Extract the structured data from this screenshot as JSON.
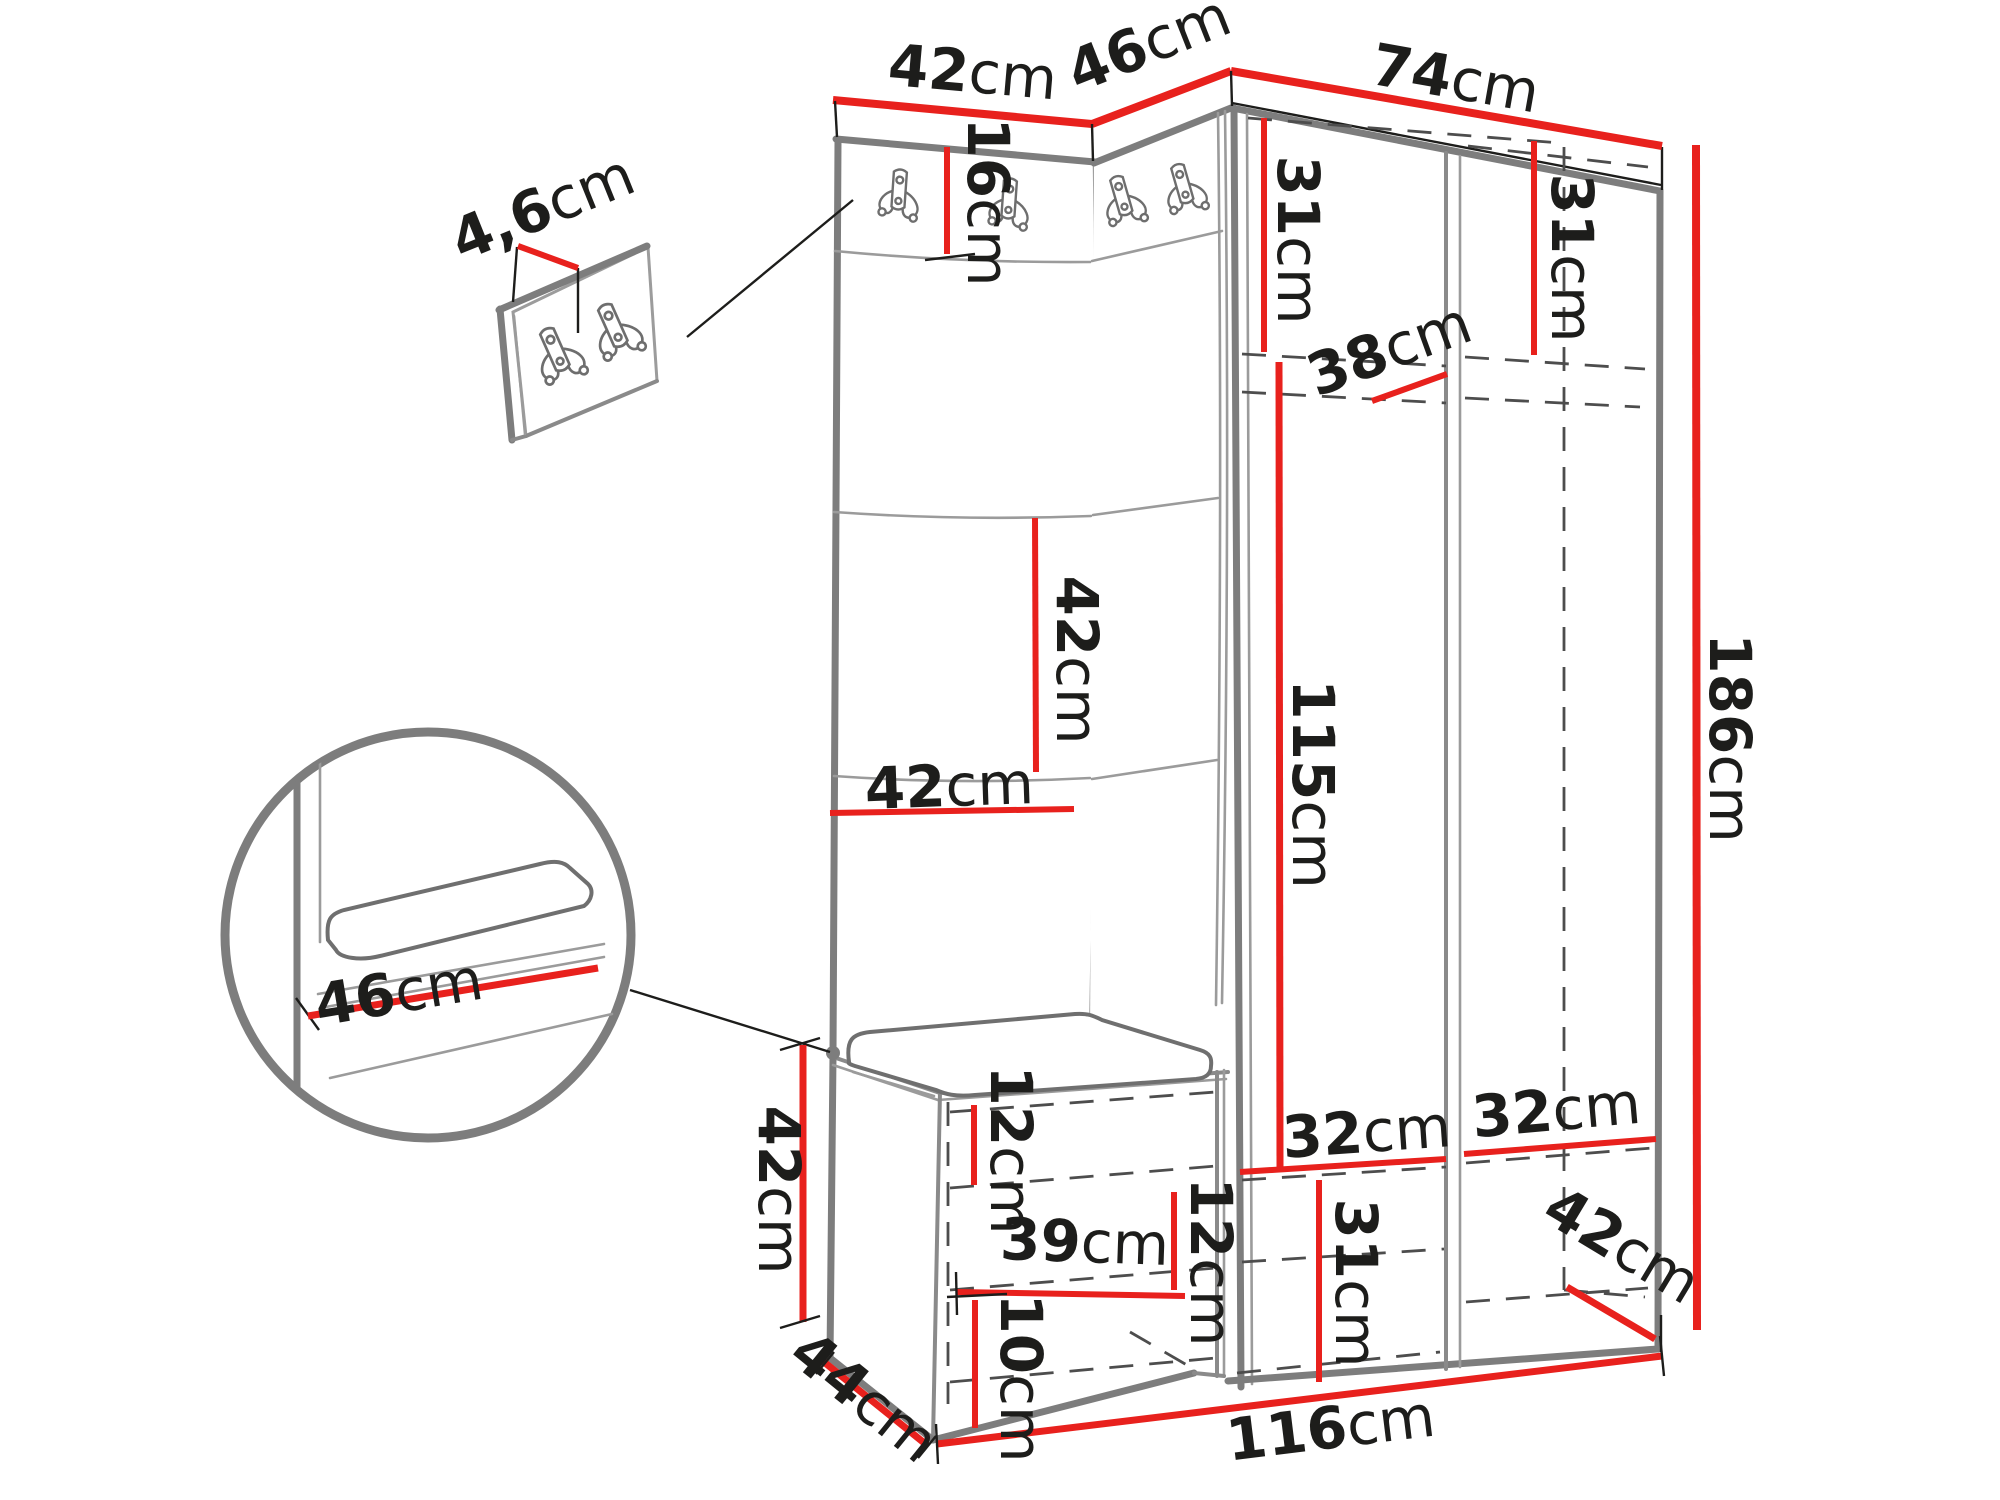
{
  "diagram": {
    "type": "furniture-dimension-diagram",
    "background": "#ffffff",
    "colors": {
      "dimension_line": "#e8211d",
      "outline_gray": "#7d7d7d",
      "hidden_line_dash": "#4d4d4d",
      "text": "#1d1d1b"
    },
    "icons": {
      "coat_hook": "double-coat-hook-icon",
      "detail_circle": "magnified-detail-circle",
      "detail_panel": "hook-panel-detail"
    },
    "dims": {
      "top_left_width": {
        "num": "42",
        "unit": "cm"
      },
      "corner_width": {
        "num": "46",
        "unit": "cm"
      },
      "right_width": {
        "num": "74",
        "unit": "cm"
      },
      "panel_thickness": {
        "num": "4,6",
        "unit": "cm"
      },
      "hook_strip_height": {
        "num": "16",
        "unit": "cm"
      },
      "upper_left_height": {
        "num": "31",
        "unit": "cm"
      },
      "upper_right_height": {
        "num": "31",
        "unit": "cm"
      },
      "shelf_width": {
        "num": "38",
        "unit": "cm"
      },
      "square_height": {
        "num": "42",
        "unit": "cm"
      },
      "panel_width": {
        "num": "42",
        "unit": "cm"
      },
      "hanging_height": {
        "num": "115",
        "unit": "cm"
      },
      "total_height": {
        "num": "186",
        "unit": "cm"
      },
      "seat_depth": {
        "num": "46",
        "unit": "cm"
      },
      "bench_height": {
        "num": "42",
        "unit": "cm"
      },
      "bench_depth": {
        "num": "44",
        "unit": "cm"
      },
      "shoe_gap_upper": {
        "num": "12",
        "unit": "cm"
      },
      "bench_inner_width": {
        "num": "39",
        "unit": "cm"
      },
      "shoe_gap_lower": {
        "num": "12",
        "unit": "cm"
      },
      "bottom_gap": {
        "num": "10",
        "unit": "cm"
      },
      "compartment_left_width": {
        "num": "32",
        "unit": "cm"
      },
      "compartment_right_width": {
        "num": "32",
        "unit": "cm"
      },
      "lower_section_height": {
        "num": "31",
        "unit": "cm"
      },
      "wardrobe_depth": {
        "num": "42",
        "unit": "cm"
      },
      "total_width": {
        "num": "116",
        "unit": "cm"
      }
    }
  }
}
